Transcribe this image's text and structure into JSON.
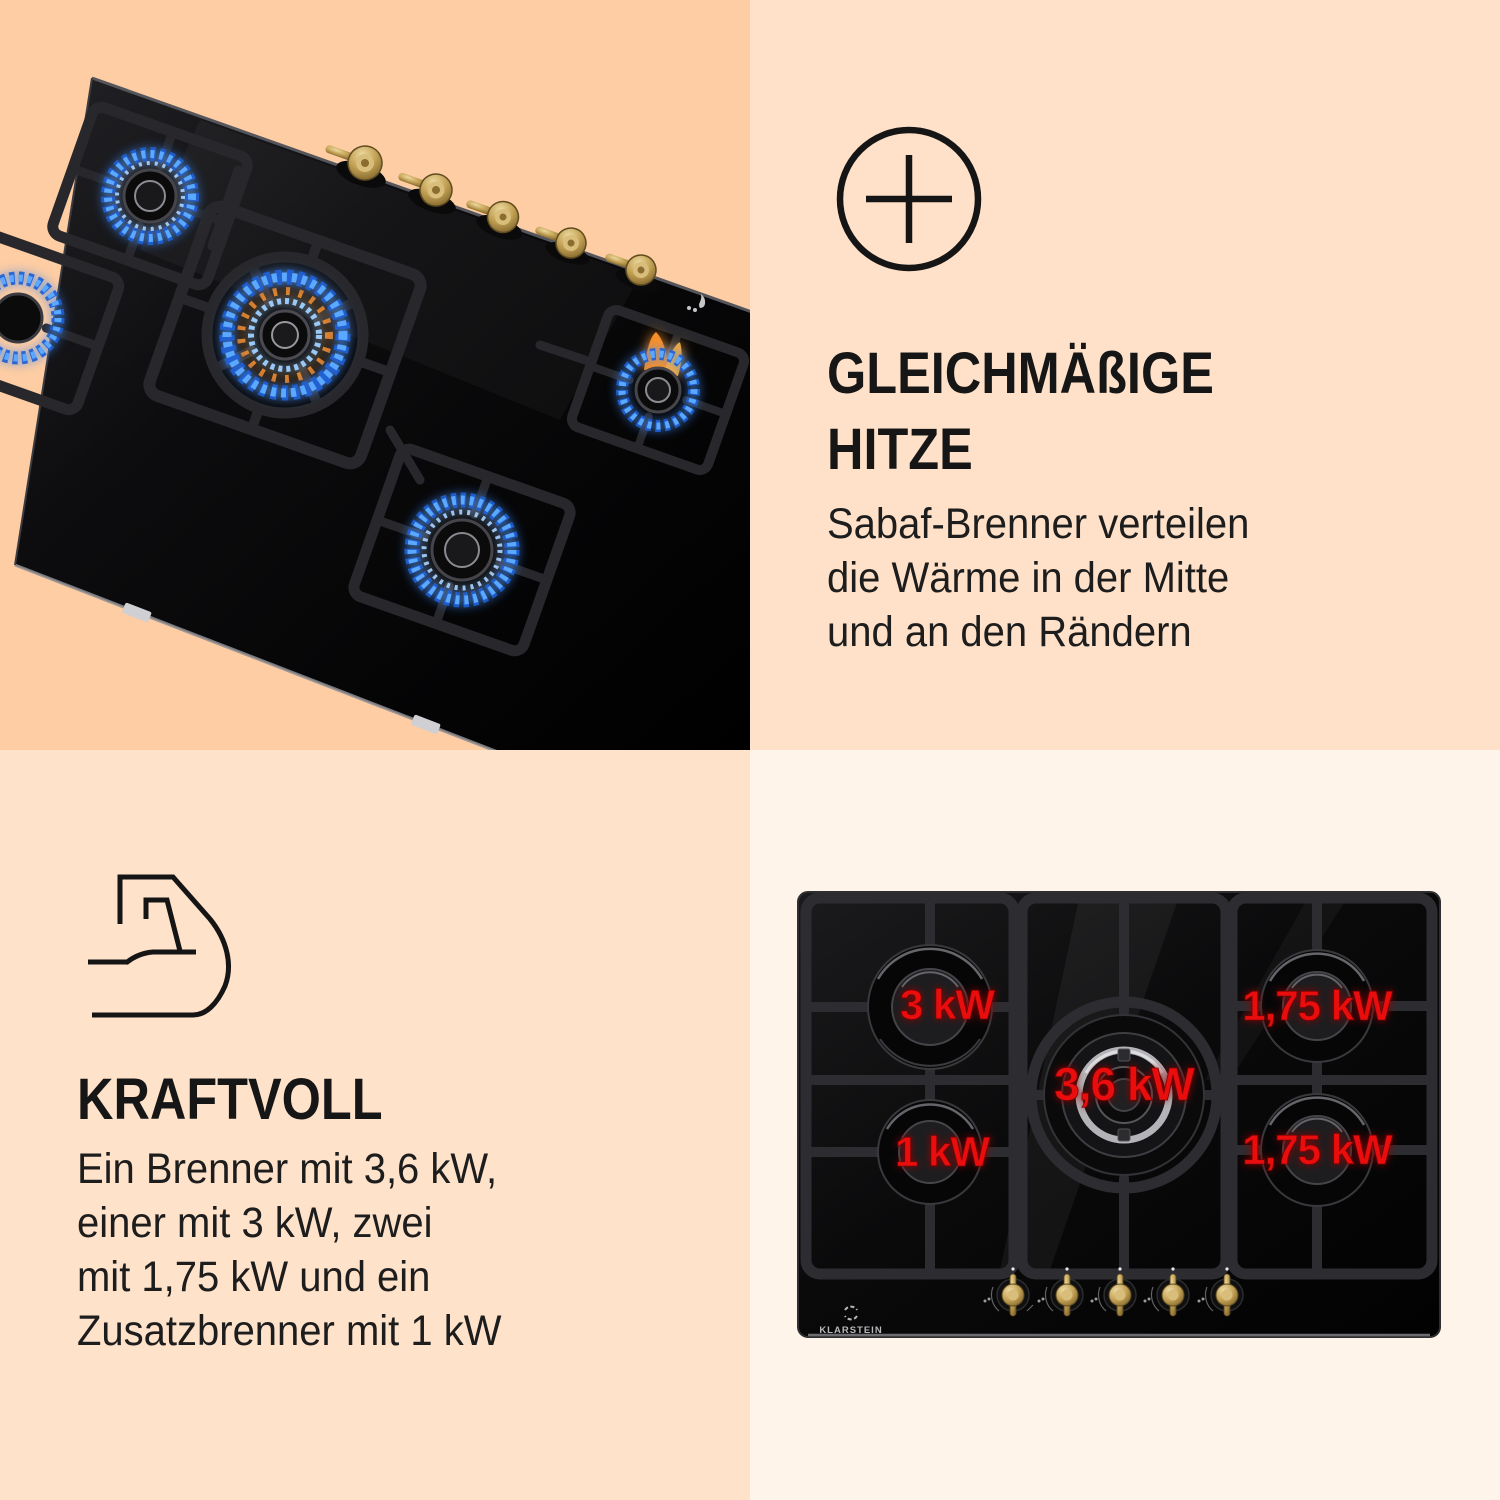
{
  "brand": "Klarstein",
  "colors": {
    "bg_top_left": "#fecda3",
    "bg_top_right": "#fee1c8",
    "bg_bottom_left": "#fee2ca",
    "bg_bottom_right": "#fff4ea",
    "accent_red": "#ea1111",
    "text": "#161616",
    "flame_blue": "#4f9dff",
    "flame_orange": "#ff9429",
    "brass": "#c3a154"
  },
  "features": [
    {
      "id": "heat",
      "icon": "plus-circle",
      "title_lines": [
        "GLEICHMÄßIGE",
        "HITZE"
      ],
      "body_lines": [
        "Sabaf-Brenner verteilen",
        "die Wärme in der Mitte",
        "und an den Rändern"
      ]
    },
    {
      "id": "power",
      "icon": "muscle-arm",
      "title_lines": [
        "KRAFTVOLL"
      ],
      "body_lines": [
        "Ein Brenner mit 3,6 kW,",
        "einer mit 3 kW, zwei",
        "mit 1,75 kW und ein",
        "Zusatzbrenner mit 1 kW"
      ]
    }
  ],
  "hob_top_view": {
    "brand_label": "KLARSTEIN",
    "knob_count": 5,
    "burners": [
      {
        "position": "left-top",
        "power_label": "3 kW"
      },
      {
        "position": "right-top",
        "power_label": "1,75 kW"
      },
      {
        "position": "center",
        "power_label": "3,6 kW"
      },
      {
        "position": "left-bottom",
        "power_label": "1 kW"
      },
      {
        "position": "right-bottom",
        "power_label": "1,75 kW"
      }
    ]
  },
  "hob_photo": {
    "burner_count": 5,
    "knob_count": 5,
    "burners_lit": true
  }
}
